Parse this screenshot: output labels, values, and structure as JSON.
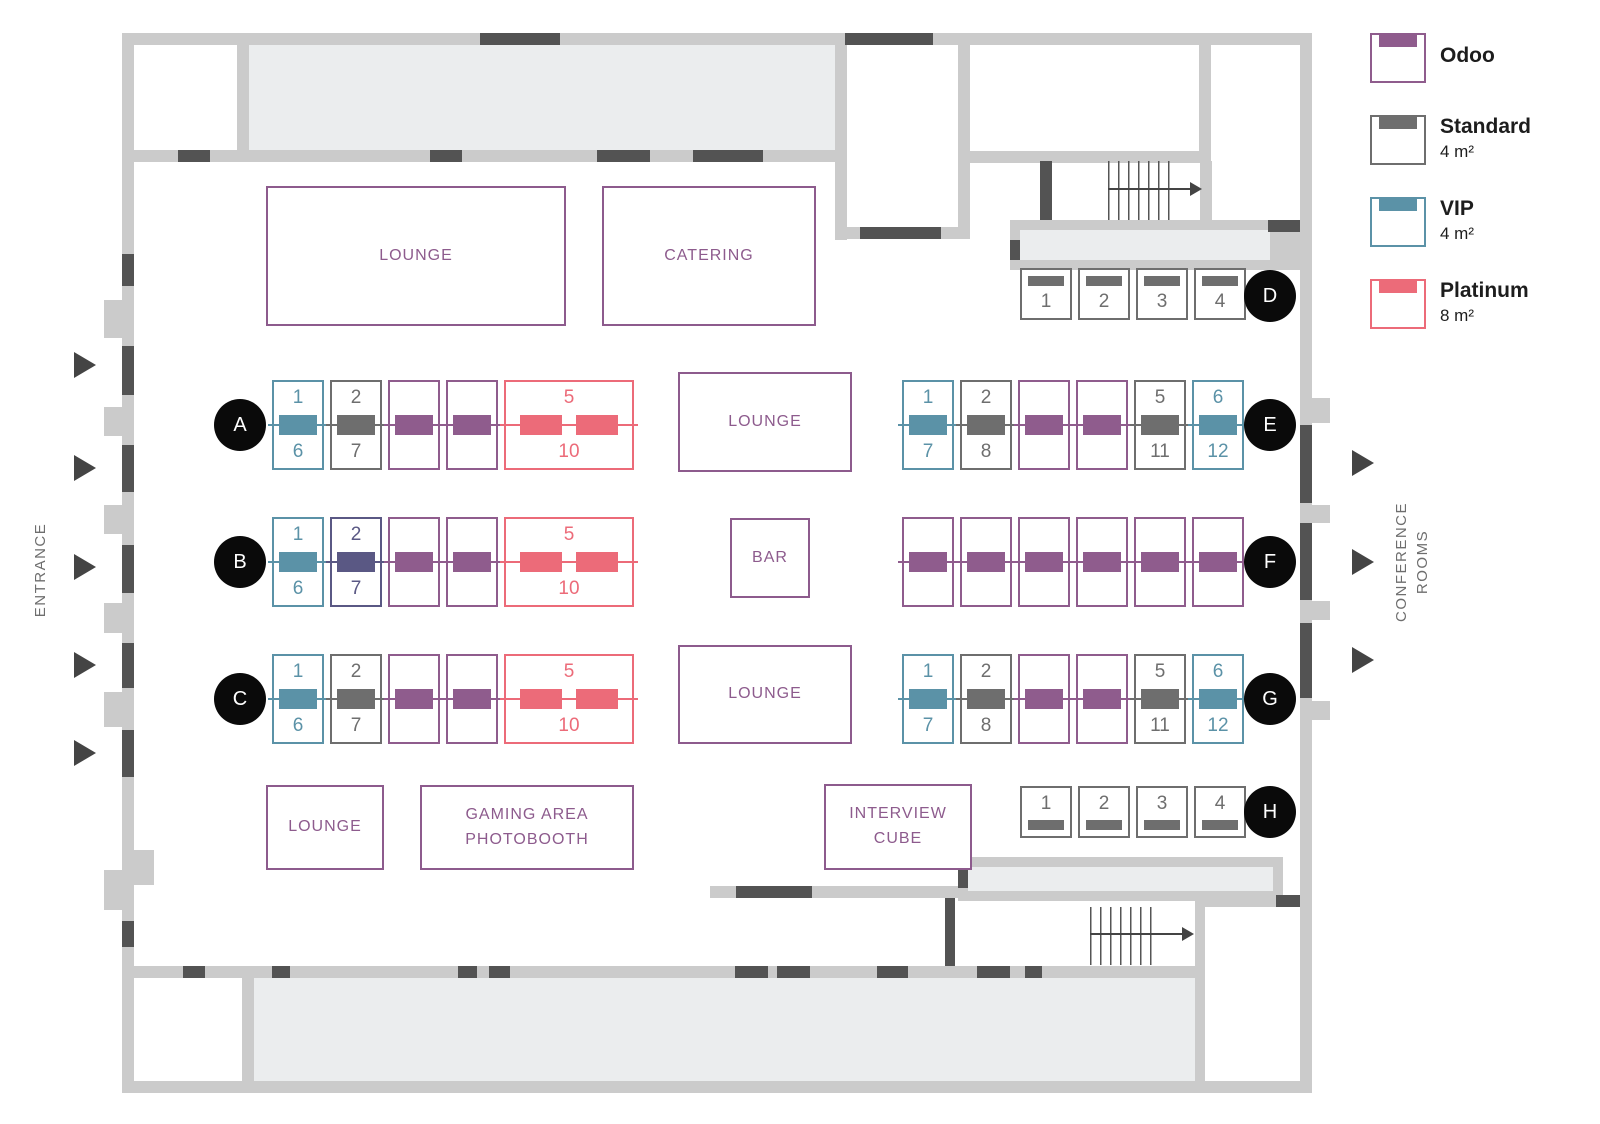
{
  "colors": {
    "odoo": "#8f5c8d",
    "standard": "#6e6e6e",
    "vip": "#5b92a7",
    "platinum": "#ec6b79",
    "unavailable": "#5a5884",
    "wall": "#cbcbcb",
    "room_fill": "#ebedee",
    "door": "#535353",
    "arrow": "#444444",
    "circle_bg": "#0a0a0a",
    "area_accent": "#8d5b8d",
    "side_text": "#6e6e6e",
    "legend_text": "#1d1d1d"
  },
  "legend": {
    "items": [
      {
        "type": "odoo",
        "label": "Odoo",
        "size": ""
      },
      {
        "type": "standard",
        "label": "Standard",
        "size": "4 m²"
      },
      {
        "type": "vip",
        "label": "VIP",
        "size": "4 m²"
      },
      {
        "type": "platinum",
        "label": "Platinum",
        "size": "8 m²"
      }
    ]
  },
  "side_labels": {
    "entrance": "ENTRANCE",
    "conference_line1": "CONFERENCE",
    "conference_line2": "ROOMS"
  },
  "areas": {
    "lounge": "LOUNGE",
    "catering": "CATERING",
    "bar": "BAR",
    "gaming_line1": "GAMING AREA",
    "gaming_line2": "PHOTOBOOTH",
    "interview_line1": "INTERVIEW",
    "interview_line2": "CUBE"
  },
  "rows": [
    {
      "letter": "A",
      "kind": "double",
      "group": "left",
      "booths": [
        {
          "type": "vip",
          "top": "1",
          "bottom": "6"
        },
        {
          "type": "standard",
          "top": "2",
          "bottom": "7"
        },
        {
          "type": "odoo"
        },
        {
          "type": "odoo"
        },
        {
          "type": "platinum",
          "top": "5",
          "bottom": "10",
          "wide": true
        }
      ]
    },
    {
      "letter": "B",
      "kind": "double",
      "group": "left",
      "booths": [
        {
          "type": "vip",
          "top": "1",
          "bottom": "6"
        },
        {
          "type": "unavailable",
          "top": "2",
          "bottom": "7"
        },
        {
          "type": "odoo"
        },
        {
          "type": "odoo"
        },
        {
          "type": "platinum",
          "top": "5",
          "bottom": "10",
          "wide": true
        }
      ]
    },
    {
      "letter": "C",
      "kind": "double",
      "group": "left",
      "booths": [
        {
          "type": "vip",
          "top": "1",
          "bottom": "6"
        },
        {
          "type": "standard",
          "top": "2",
          "bottom": "7"
        },
        {
          "type": "odoo"
        },
        {
          "type": "odoo"
        },
        {
          "type": "platinum",
          "top": "5",
          "bottom": "10",
          "wide": true
        }
      ]
    },
    {
      "letter": "D",
      "kind": "single-top",
      "group": "single",
      "booths": [
        {
          "type": "standard",
          "label": "1"
        },
        {
          "type": "standard",
          "label": "2"
        },
        {
          "type": "standard",
          "label": "3"
        },
        {
          "type": "standard",
          "label": "4"
        }
      ]
    },
    {
      "letter": "E",
      "kind": "double",
      "group": "right",
      "booths": [
        {
          "type": "vip",
          "top": "1",
          "bottom": "7"
        },
        {
          "type": "standard",
          "top": "2",
          "bottom": "8"
        },
        {
          "type": "odoo"
        },
        {
          "type": "odoo"
        },
        {
          "type": "standard",
          "top": "5",
          "bottom": "11"
        },
        {
          "type": "vip",
          "top": "6",
          "bottom": "12"
        }
      ]
    },
    {
      "letter": "F",
      "kind": "double",
      "group": "right",
      "booths": [
        {
          "type": "odoo"
        },
        {
          "type": "odoo"
        },
        {
          "type": "odoo"
        },
        {
          "type": "odoo"
        },
        {
          "type": "odoo"
        },
        {
          "type": "odoo"
        }
      ]
    },
    {
      "letter": "G",
      "kind": "double",
      "group": "right",
      "booths": [
        {
          "type": "vip",
          "top": "1",
          "bottom": "7"
        },
        {
          "type": "standard",
          "top": "2",
          "bottom": "8"
        },
        {
          "type": "odoo"
        },
        {
          "type": "odoo"
        },
        {
          "type": "standard",
          "top": "5",
          "bottom": "11"
        },
        {
          "type": "vip",
          "top": "6",
          "bottom": "12"
        }
      ]
    },
    {
      "letter": "H",
      "kind": "single-bottom",
      "group": "single",
      "booths": [
        {
          "type": "standard",
          "label": "1"
        },
        {
          "type": "standard",
          "label": "2"
        },
        {
          "type": "standard",
          "label": "3"
        },
        {
          "type": "standard",
          "label": "4"
        }
      ]
    }
  ]
}
